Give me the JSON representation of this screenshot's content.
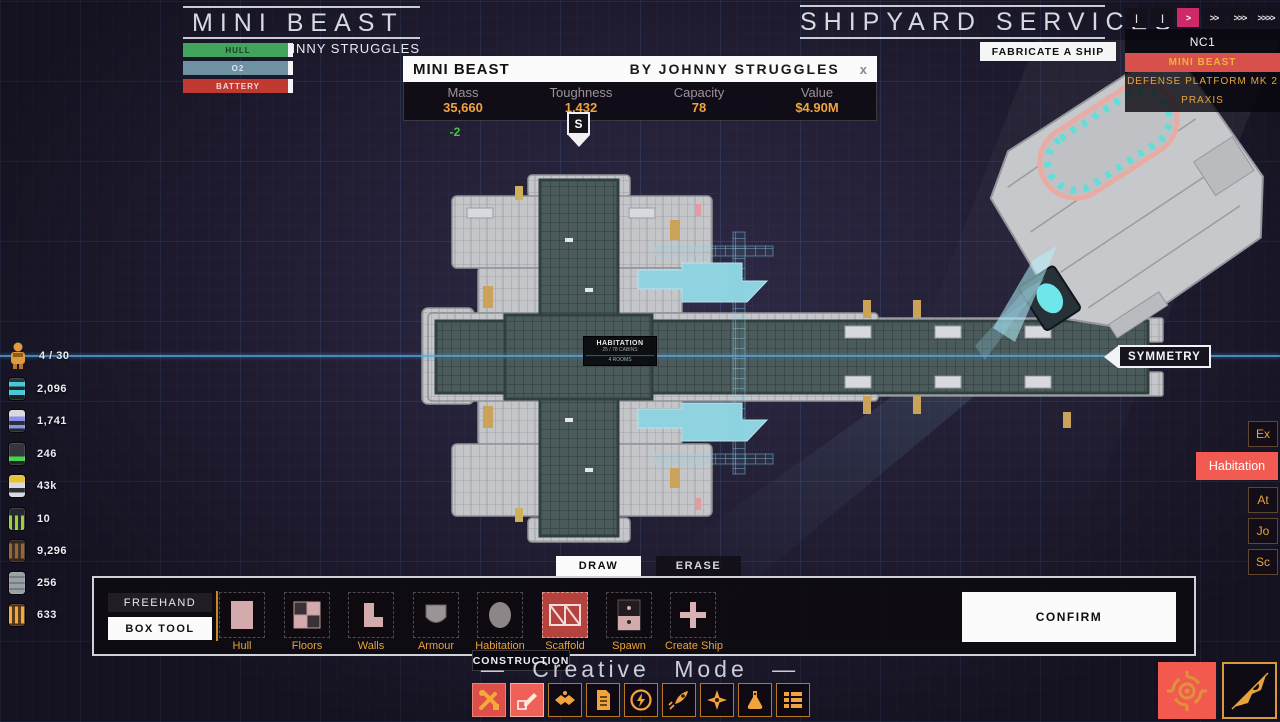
{
  "title_block": {
    "title": "MINI BEAST",
    "author": "BY JOHNNY STRUGGLES",
    "bars": [
      {
        "label": "HULL",
        "color": "#41a65c",
        "text_color": "#173a22"
      },
      {
        "label": "O2",
        "color": "#6e92a2",
        "text_color": "#dde6ea"
      },
      {
        "label": "BATTERY",
        "color": "#c13a31",
        "text_color": "#f2d8d5"
      }
    ]
  },
  "info_popup": {
    "title": "MINI BEAST",
    "author": "BY JOHNNY STRUGGLES",
    "close_label": "x",
    "stats": [
      {
        "label": "Mass",
        "value": "35,660"
      },
      {
        "label": "Toughness",
        "value": "1,432"
      },
      {
        "label": "Capacity",
        "value": "78"
      },
      {
        "label": "Value",
        "value": "$4.90M"
      }
    ],
    "delta": "-2",
    "symmetry_marker": "S"
  },
  "shipyard": {
    "title": "SHIPYARD SERVICES",
    "fabricate_label": "FABRICATE A SHIP"
  },
  "fleet_panel": {
    "nav_buttons": [
      "|",
      "|",
      ">",
      ">>",
      ">>>",
      ">>>>"
    ],
    "active_nav_index": 2,
    "ships": [
      {
        "name": "NC1",
        "state": "plain"
      },
      {
        "name": "MINI BEAST",
        "state": "selected"
      },
      {
        "name": "DEFENSE PLATFORM MK 2",
        "state": "normal"
      },
      {
        "name": "PRAXIS",
        "state": "normal"
      }
    ]
  },
  "resources": [
    {
      "icon": "crew-icon",
      "value": "4 / 30"
    },
    {
      "icon": "oxygen-tank-icon",
      "value": "2,096"
    },
    {
      "icon": "fuel-tank-icon",
      "value": "1,741"
    },
    {
      "icon": "battery-icon",
      "value": "246"
    },
    {
      "icon": "fuel-drum-icon",
      "value": "43k"
    },
    {
      "icon": "power-cell-icon",
      "value": "10"
    },
    {
      "icon": "metal-rack-icon",
      "value": "9,296"
    },
    {
      "icon": "component-crate-icon",
      "value": "256"
    },
    {
      "icon": "ingot-rack-icon",
      "value": "633"
    }
  ],
  "canvas": {
    "habitation_label": {
      "title": "HABITATION",
      "cabins": "25 / 78 CABINS",
      "rooms": "4 ROOMS"
    },
    "symmetry_label": "SYMMETRY"
  },
  "category_buttons": [
    {
      "label": "Ex",
      "selected": false
    },
    {
      "label": "Habitation",
      "selected": true
    },
    {
      "label": "At",
      "selected": false
    },
    {
      "label": "Jo",
      "selected": false
    },
    {
      "label": "Sc",
      "selected": false
    }
  ],
  "build_toolbar": {
    "tabs": [
      {
        "label": "DRAW",
        "selected": true
      },
      {
        "label": "ERASE",
        "selected": false
      }
    ],
    "modes": [
      {
        "label": "FREEHAND",
        "selected": false
      },
      {
        "label": "BOX TOOL",
        "selected": true
      }
    ],
    "tools": [
      {
        "label": "Hull",
        "icon": "hull-icon",
        "selected": false
      },
      {
        "label": "Floors",
        "icon": "floors-icon",
        "selected": false
      },
      {
        "label": "Walls",
        "icon": "walls-icon",
        "selected": false
      },
      {
        "label": "Armour",
        "icon": "armour-icon",
        "selected": false
      },
      {
        "label": "Habitation",
        "icon": "habitation-icon",
        "selected": false
      },
      {
        "label": "Scaffold",
        "icon": "scaffold-icon",
        "selected": true
      },
      {
        "label": "Spawn",
        "icon": "spawn-icon",
        "selected": false
      },
      {
        "label": "Create Ship",
        "icon": "create-ship-icon",
        "selected": false
      }
    ],
    "confirm_label": "CONFIRM",
    "tooltip": "CONSTRUCTION"
  },
  "footer": {
    "mode_label": "— Creative Mode —",
    "menu_icons": [
      "construction-tools-icon",
      "edit-pencil-icon",
      "trade-handshake-icon",
      "contracts-document-icon",
      "power-bolt-icon",
      "thruster-rocket-icon",
      "navigation-compass-icon",
      "research-flask-icon",
      "inventory-list-icon"
    ]
  },
  "hud_buttons": {
    "left_icon": "target-crosshair-icon",
    "right_icon": "launch-ship-icon"
  },
  "colors": {
    "accent_orange": "#e8a33d",
    "alert_red": "#e4544d",
    "selected_pink": "#ce2a68",
    "habitation_cyan": "#8ed3df",
    "symmetry_blue": "#56a8e4",
    "hull_gray": "#c6c8cc",
    "interior_teal": "#4b5a5b"
  }
}
